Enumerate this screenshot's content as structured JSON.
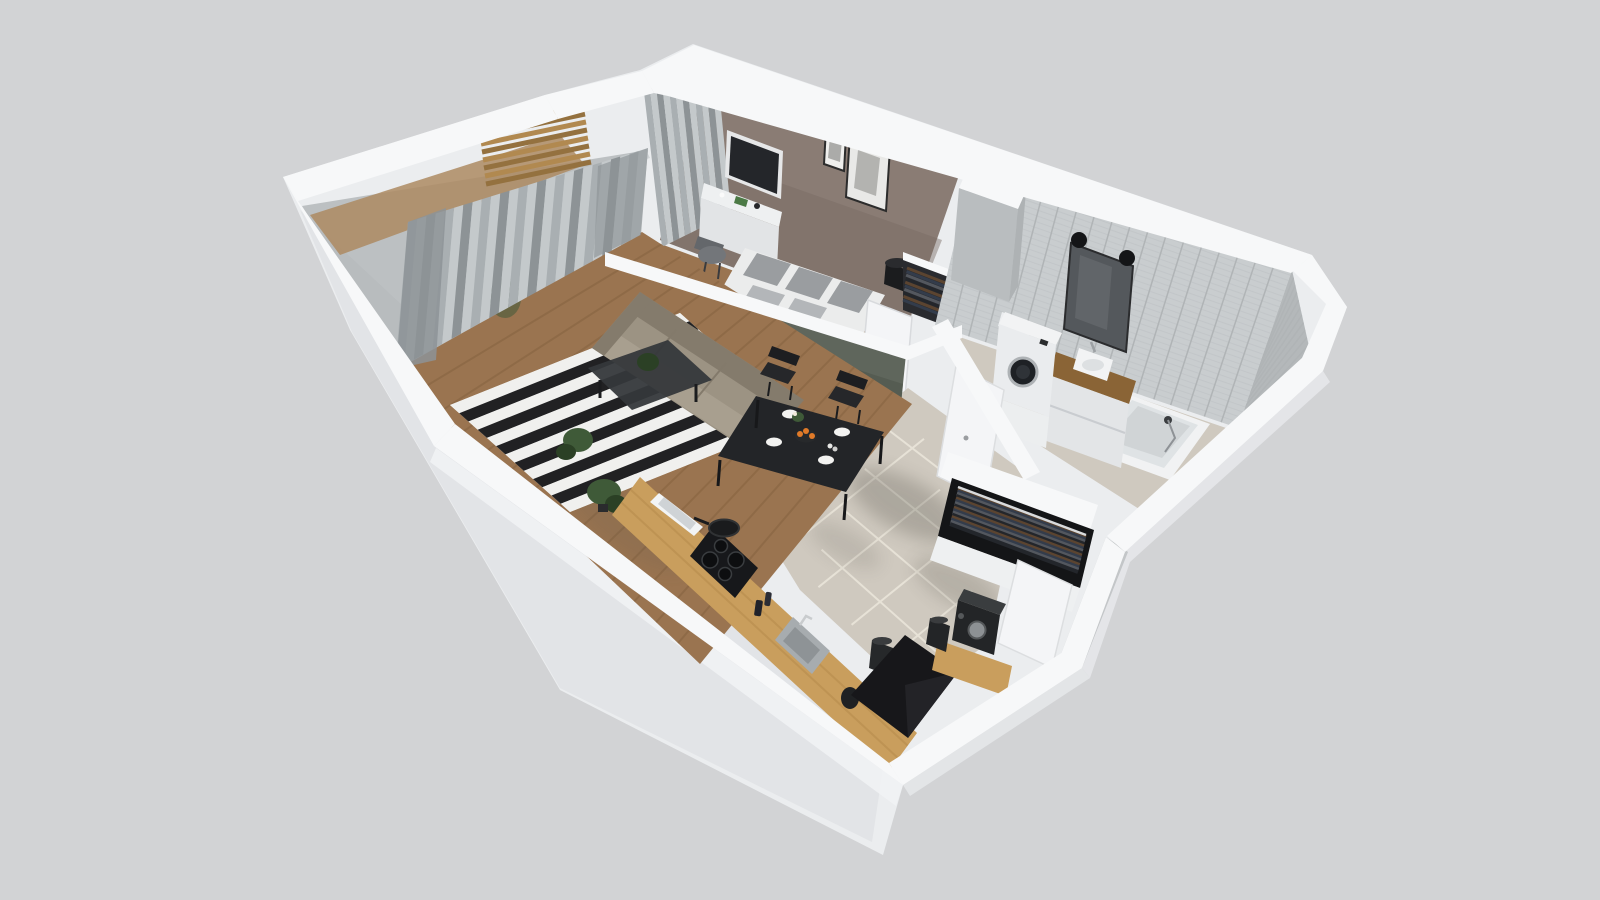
{
  "meta": {
    "title": "3D apartment floor plan — isometric cutaway render",
    "view": "isometric-3d-cutaway",
    "render_style": "architectural visualization, no text labels"
  },
  "background": "#d2d3d5",
  "palette": {
    "bg": "#d2d3d5",
    "shell": "#ebedef",
    "shell_deep": "#dcdee1",
    "shell_bright": "#f1f2f4",
    "band": "#f7f8f9",
    "taupe": "#8a7c74",
    "taupe_dark": "#776b64",
    "sage": "#5f665c",
    "sage_dark": "#4b5248",
    "tile_wall": "#c9cdcf",
    "tile_wall_dark": "#b4b8ba",
    "tile_line": "#b0b4b6",
    "wood": "#9a7450",
    "wood_light": "#ad8a61",
    "plank_line": "#82603c",
    "counter_wood": "#c99e5d",
    "counter_streak": "#a87f42",
    "tile_floor": "#cfc9bf",
    "grout": "#e7e2d7",
    "rug_dark": "#212123",
    "rug_light": "#f0f0ee",
    "curtain_a": "#a9afb2",
    "curtain_b": "#c4c9cb",
    "curtain_c": "#8d9396",
    "glass": "#c6cbcd",
    "sofa": "#9c9383",
    "sofa_dark": "#847b6c",
    "sofa_light": "#a89f8f",
    "dark": "#232528",
    "black": "#141517",
    "bed_white": "#ebecec",
    "throw": "#30323a",
    "pillow_a": "#9a9da0",
    "pillow_b": "#b3b6b9",
    "appliance": "#eaecee",
    "chrome": "#9da1a4",
    "vanity_wood": "#8a6436",
    "plant": "#3f5a38",
    "plant_dark": "#2b4025",
    "orange": "#e07a28",
    "slat": "#b18950",
    "slat_dark": "#94713f",
    "void": "#17171a",
    "void_lit": "#232327",
    "door_white": "#f4f5f7",
    "shadow": "#5f5c52",
    "hang1": "#5b4430",
    "hang2": "#333c4b",
    "hang3": "#53575e",
    "hang4": "#23262b",
    "mirror": "#54585c",
    "white": "#f2f3f5"
  },
  "scene": {
    "rooms": [
      {
        "id": "living-room",
        "floor": "wood planks",
        "furniture": [
          "beige-sofa",
          "black-white-striped-rug",
          "dark-coffee-table",
          "black-dining-table",
          "dining-chairs-x4",
          "floor-plants-x2",
          "full-height-gray-curtains"
        ]
      },
      {
        "id": "bedroom",
        "wall": "taupe accent wall",
        "furniture": [
          "double-bed-white-linen",
          "gray-pillows-x5",
          "dark-throw-blanket",
          "white-desk",
          "gray-desk-chair",
          "wall-mounted-tv",
          "picture-frames-x2",
          "open-clothes-rack",
          "black-table-lamp",
          "window-curtains"
        ]
      },
      {
        "id": "bathroom",
        "wall": "light gray subway tile",
        "furniture": [
          "washing-machine",
          "wood-vanity-with-white-sink",
          "dark-mirror-with-round-hangers",
          "bathtub-with-hand-shower",
          "toilet",
          "vent-shaft"
        ]
      },
      {
        "id": "hallway",
        "floor": "large beige tiles",
        "furniture": [
          "open-wardrobe-hanging-clothes",
          "white-interior-doors-x2",
          "coffee-machine",
          "grinder"
        ]
      },
      {
        "id": "kitchen",
        "floor": "wood planks",
        "furniture": [
          "wooden-countertop",
          "induction-cooktop",
          "frying-pan",
          "gray-sink",
          "bottles",
          "kettle",
          "window-recess"
        ]
      },
      {
        "id": "balcony",
        "furniture": [
          "wood-slat-feature-wall",
          "sheer-curtain-wall",
          "potted-plant",
          "wood-decking"
        ]
      }
    ],
    "special": [
      "dark-floor-void-at-entrance",
      "white-wall-top-bands",
      "cast-shadows-on-tile"
    ],
    "counts": {
      "dining_chairs": 4,
      "bed_pillows": 5,
      "wardrobe_hangers": 16,
      "wood_slats": 8,
      "rug_stripes": 13
    }
  }
}
